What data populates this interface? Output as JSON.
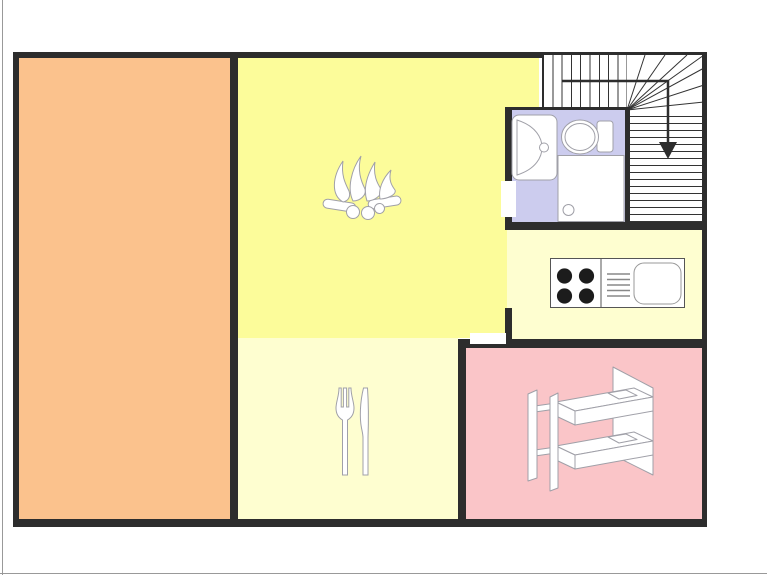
{
  "palette": {
    "wall": "#2d2d2d",
    "page_edge": "#999999",
    "furniture_outline": "#a0a0a8",
    "stair_line": "#333333",
    "burner": "#1c1c1c"
  },
  "rooms": {
    "left_room": {
      "label": "large orange room",
      "color": "#FBC28D"
    },
    "living_room": {
      "label": "living room with campfire fireplace icon",
      "color": "#FCFC9A"
    },
    "dining_room": {
      "label": "dining room with fork and knife icon",
      "color": "#FEFED0"
    },
    "kitchen": {
      "label": "kitchen with stove and sink unit",
      "color": "#FEFED0"
    },
    "bedroom": {
      "label": "bedroom with bunk bed icon",
      "color": "#FAC5C8"
    },
    "bathroom": {
      "label": "bathroom with sink, toilet and shower",
      "color": "#CCCCEE"
    },
    "stairs": {
      "label": "winding staircase, arrow pointing down",
      "color": "#FFFFFF",
      "direction": "down"
    }
  },
  "icons": [
    "campfire-icon",
    "fork-knife-icon",
    "bunk-bed-icon",
    "bath-sink-icon",
    "toilet-icon",
    "shower-icon",
    "stove-burners-icon",
    "kitchen-sink-icon",
    "stair-arrow-down-icon"
  ]
}
